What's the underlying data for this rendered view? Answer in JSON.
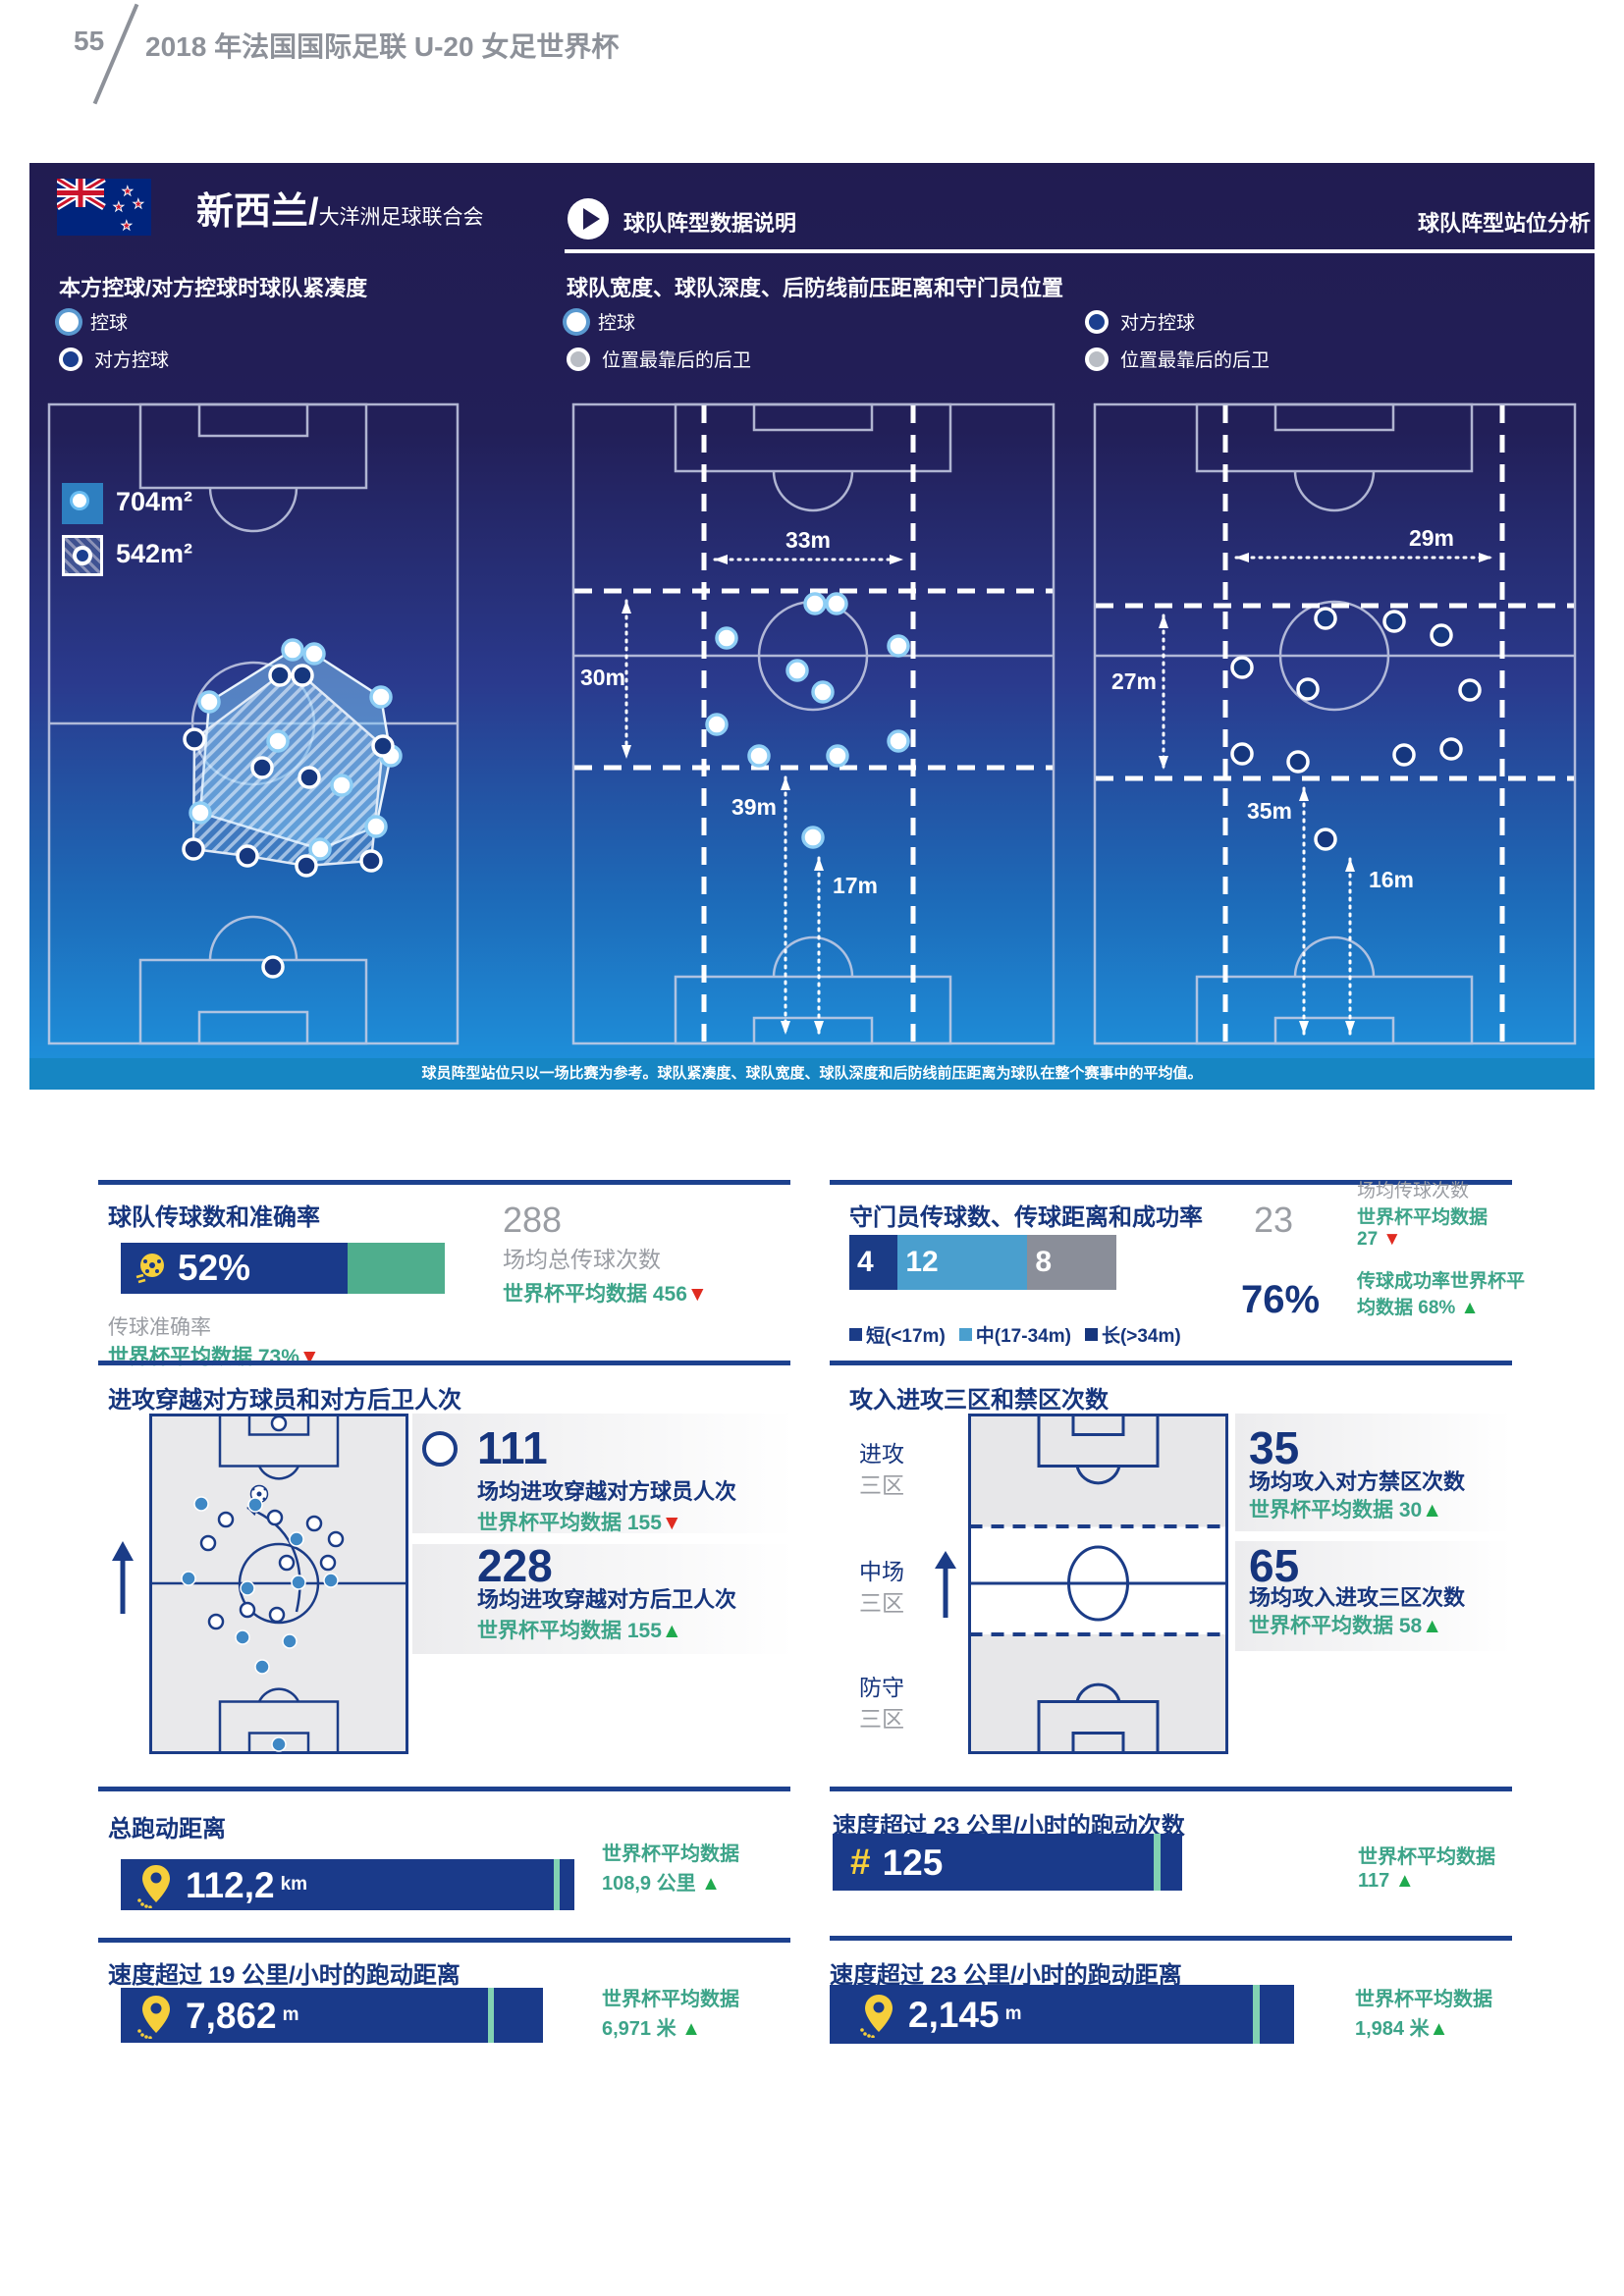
{
  "header": {
    "page_number": "55",
    "title": "2018 年法国国际足联 U-20 女足世界杯"
  },
  "panel": {
    "team_name": "新西兰/",
    "confederation": "大洋洲足球联合会",
    "section_title": "球队阵型数据说明",
    "analysis_title": "球队阵型站位分析",
    "compactness": {
      "title": "本方控球/对方控球时球队紧凑度",
      "legend_possession": "控球",
      "legend_opponent": "对方控球",
      "possession_area": "704m²",
      "opponent_area": "542m²"
    },
    "formation": {
      "title": "球队宽度、球队深度、后防线前压距离和守门员位置",
      "legend_possession": "控球",
      "legend_deepest": "位置最靠后的后卫",
      "legend_opponent": "对方控球",
      "legend_deepest2": "位置最靠后的后卫",
      "possession": {
        "width": "33m",
        "depth": "30m",
        "line": "39m",
        "gk": "17m"
      },
      "opponent": {
        "width": "29m",
        "depth": "27m",
        "line": "35m",
        "gk": "16m"
      }
    },
    "footnote": "球员阵型站位只以一场比赛为参考。球队紧凑度、球队宽度、球队深度和后防线前压距离为球队在整个赛事中的平均值。"
  },
  "passing": {
    "title": "球队传球数和准确率",
    "accuracy": "52%",
    "total": "288",
    "total_label": "场均总传球次数",
    "avg_label": "世界杯平均数据",
    "total_avg": "456",
    "total_trend": "▼",
    "accuracy_label": "传球准确率",
    "accuracy_avg_label": "世界杯平均数据",
    "accuracy_avg": "73%",
    "accuracy_trend": "▼"
  },
  "gk": {
    "title": "守门员传球数、传球距离和成功率",
    "short": "4",
    "mid": "12",
    "long": "8",
    "legend_short": "短(<17m)",
    "legend_mid": "中(17-34m)",
    "legend_long": "长(>34m)",
    "passes": "23",
    "passes_label": "场均传球次数",
    "avg_label": "世界杯平均数据",
    "passes_avg": "27",
    "passes_trend": "▼",
    "success": "76%",
    "success_label": "传球成功率世界杯平均数据",
    "success_avg": "68%",
    "success_trend": "▲"
  },
  "penetration": {
    "title": "进攻穿越对方球员和对方后卫人次",
    "players": "111",
    "players_label": "场均进攻穿越对方球员人次",
    "players_avg_label": "世界杯平均数据",
    "players_avg": "155",
    "players_trend": "▼",
    "defenders": "228",
    "defenders_label": "场均进攻穿越对方后卫人次",
    "defenders_avg_label": "世界杯平均数据",
    "defenders_avg": "155",
    "defenders_trend": "▲"
  },
  "thirds": {
    "title": "攻入进攻三区和禁区次数",
    "zones": {
      "attack1": "进攻",
      "attack2": "三区",
      "mid1": "中场",
      "mid2": "三区",
      "def1": "防守",
      "def2": "三区"
    },
    "box": "35",
    "box_label": "场均攻入对方禁区次数",
    "box_avg_label": "世界杯平均数据",
    "box_avg": "30",
    "box_trend": "▲",
    "third": "65",
    "third_label": "场均攻入进攻三区次数",
    "third_avg_label": "世界杯平均数据",
    "third_avg": "58",
    "third_trend": "▲"
  },
  "distance": {
    "title": "总跑动距离",
    "value": "112,2",
    "unit": "km",
    "avg_label": "世界杯平均数据",
    "avg_value": "108,9 公里",
    "trend": "▲"
  },
  "sprints": {
    "title": "速度超过 23 公里/小时的跑动次数",
    "hash": "#",
    "value": "125",
    "avg_label": "世界杯平均数据",
    "avg_value": "117",
    "trend": "▲"
  },
  "hsr": {
    "title": "速度超过 19 公里/小时的跑动距离",
    "value": "7,862",
    "unit": "m",
    "avg_label": "世界杯平均数据",
    "avg_value": "6,971 米",
    "trend": "▲"
  },
  "sprint_dist": {
    "title": "速度超过 23 公里/小时的跑动距离",
    "value": "2,145",
    "unit": "m",
    "avg_label": "世界杯平均数据",
    "avg_value": "1,984 米",
    "trend": "▲"
  }
}
